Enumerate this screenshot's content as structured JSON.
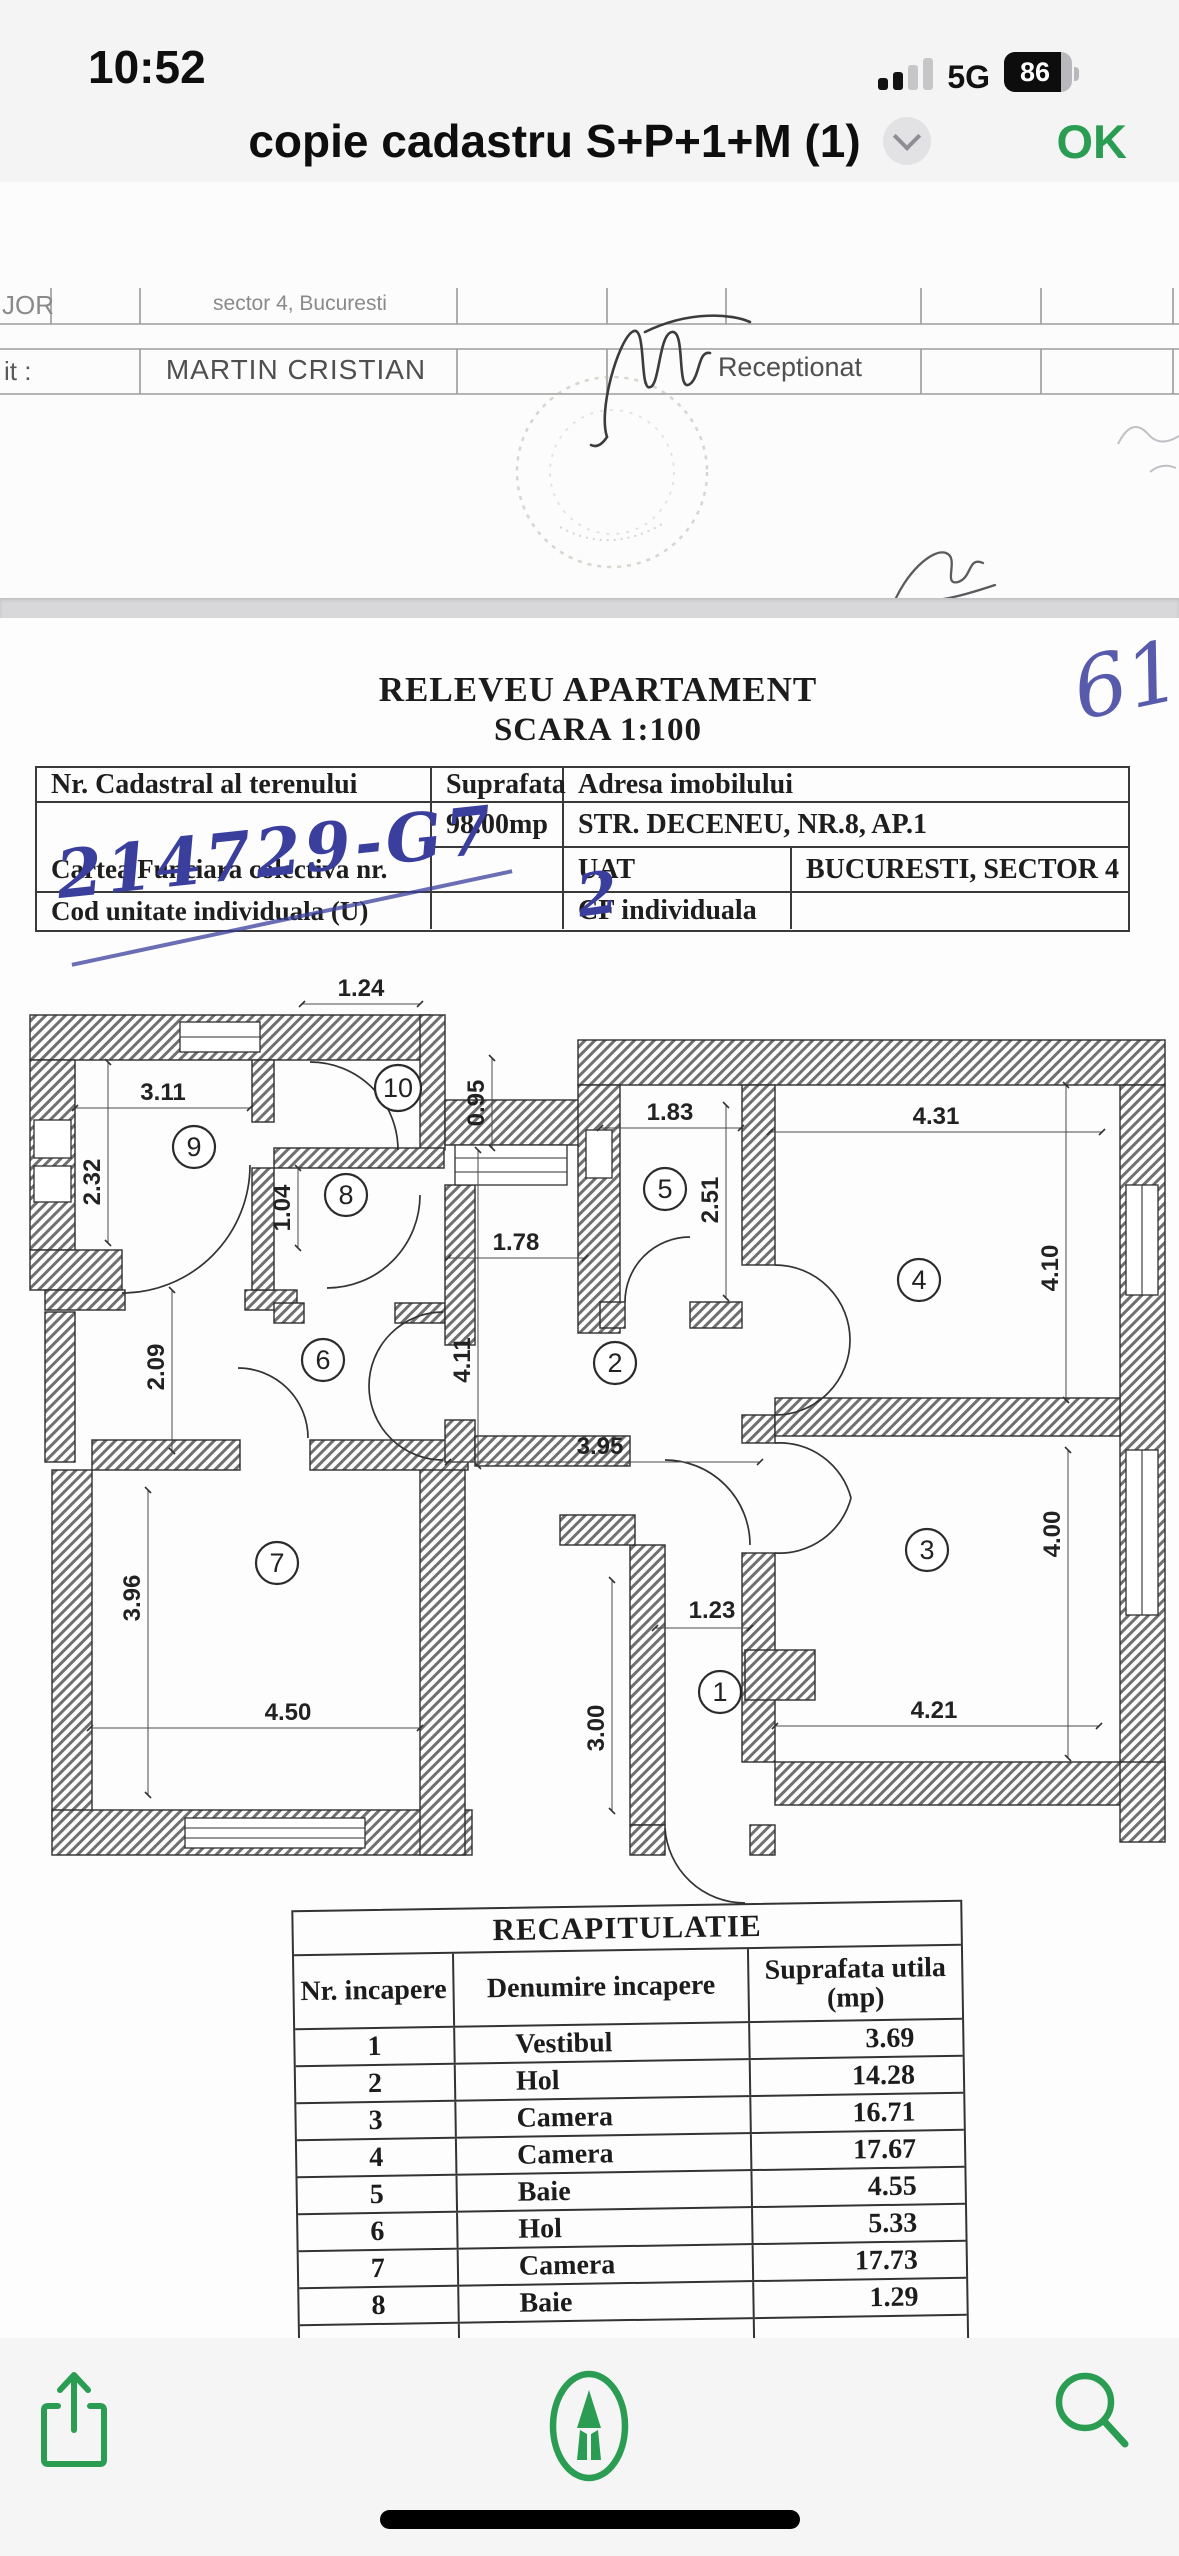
{
  "status_bar": {
    "time": "10:52",
    "network": "5G",
    "battery_percent": "86"
  },
  "title_bar": {
    "title": "copie cadastru S+P+1+M (1)",
    "ok_label": "OK"
  },
  "colors": {
    "accent_green": "#2a9d52",
    "ink_blue": "#3a3e9c"
  },
  "page1": {
    "cell_top_left": "JOR",
    "cell_sector": "sector 4, Bucuresti",
    "label_left": "it :",
    "name": "MARTIN CRISTIAN",
    "receptionat_label": "Receptionat"
  },
  "page2": {
    "handwritten_corner": "6144",
    "heading_line1": "RELEVEU APARTAMENT",
    "heading_line2": "SCARA 1:100",
    "info_table": {
      "nr_cadastral_label": "Nr. Cadastral al terenului",
      "suprafata_label": "Suprafata",
      "adresa_label": "Adresa imobilului",
      "handwritten_cadastral": "214729-G7",
      "suprafata_value": "98.00mp",
      "adresa_value": "STR. DECENEU, NR.8, AP.1",
      "cartea_funciara_label": "Cartea Funciara colectiva nr.",
      "cartea_funciara_handwritten": "2",
      "uat_label": "UAT",
      "uat_value": "BUCURESTI, SECTOR 4",
      "cod_unitate_label": "Cod unitate individuala (U)",
      "cf_label": "CF individuala"
    },
    "floor_plan": {
      "rooms": [
        {
          "number": "9"
        },
        {
          "number": "10"
        },
        {
          "number": "8"
        },
        {
          "number": "6"
        },
        {
          "number": "7"
        },
        {
          "number": "5"
        },
        {
          "number": "2"
        },
        {
          "number": "4"
        },
        {
          "number": "3"
        },
        {
          "number": "1"
        }
      ],
      "dimensions": [
        {
          "value": "1.24"
        },
        {
          "value": "3.11"
        },
        {
          "value": "0.95"
        },
        {
          "value": "2.32"
        },
        {
          "value": "1.04"
        },
        {
          "value": "2.09"
        },
        {
          "value": "1.78"
        },
        {
          "value": "4.11"
        },
        {
          "value": "1.83"
        },
        {
          "value": "2.51"
        },
        {
          "value": "4.31"
        },
        {
          "value": "4.10"
        },
        {
          "value": "3.95"
        },
        {
          "value": "3.96"
        },
        {
          "value": "4.50"
        },
        {
          "value": "1.23"
        },
        {
          "value": "3.00"
        },
        {
          "value": "4.21"
        },
        {
          "value": "4.00"
        }
      ]
    },
    "recap_table": {
      "title": "RECAPITULATIE",
      "col_nr": "Nr. incapere",
      "col_denumire": "Denumire incapere",
      "col_suprafata": "Suprafata utila (mp)",
      "rows": [
        {
          "nr": "1",
          "denumire": "Vestibul",
          "suprafata": "3.69"
        },
        {
          "nr": "2",
          "denumire": "Hol",
          "suprafata": "14.28"
        },
        {
          "nr": "3",
          "denumire": "Camera",
          "suprafata": "16.71"
        },
        {
          "nr": "4",
          "denumire": "Camera",
          "suprafata": "17.67"
        },
        {
          "nr": "5",
          "denumire": "Baie",
          "suprafata": "4.55"
        },
        {
          "nr": "6",
          "denumire": "Hol",
          "suprafata": "5.33"
        },
        {
          "nr": "7",
          "denumire": "Camera",
          "suprafata": "17.73"
        },
        {
          "nr": "8",
          "denumire": "Baie",
          "suprafata": "1.29"
        }
      ]
    }
  }
}
